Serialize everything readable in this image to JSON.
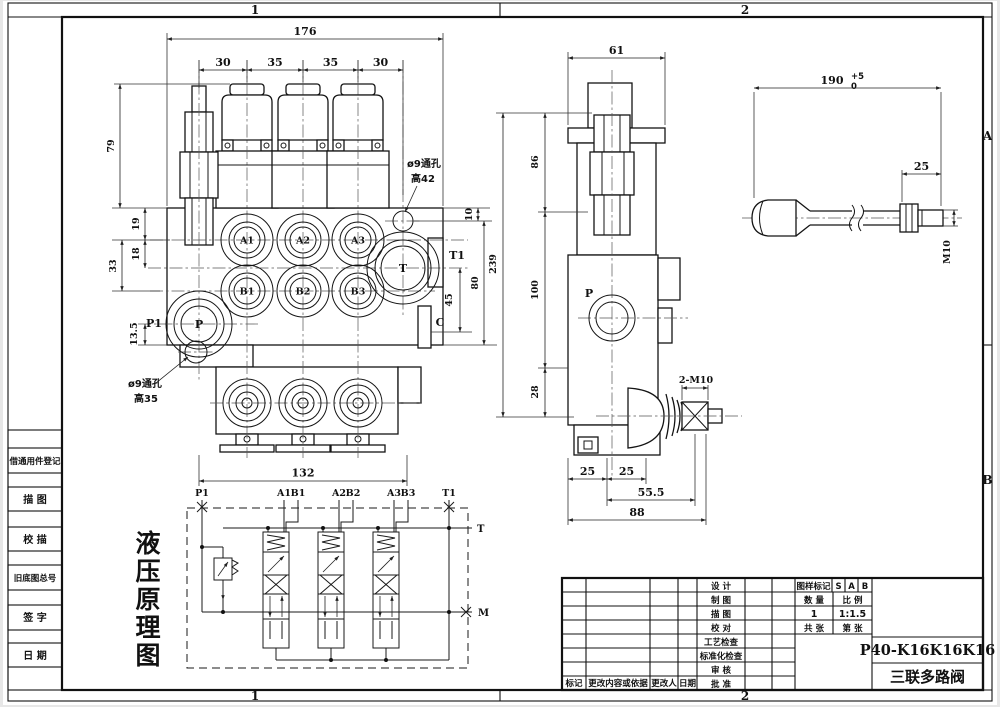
{
  "sheet": {
    "zones": {
      "top": [
        "1",
        "2"
      ],
      "bottom": [
        "1",
        "2"
      ],
      "right": [
        "A",
        "B"
      ]
    },
    "register_column": {
      "cells": [
        "借通用件登记",
        "描  图",
        "校  描",
        "旧底图总号",
        "签  字",
        "日  期"
      ]
    }
  },
  "front_view": {
    "dims": {
      "overall_width": "176",
      "spacings": [
        "30",
        "35",
        "35",
        "30"
      ],
      "height_top": "79",
      "a_offset": "19",
      "t_offset": "18",
      "b_offset": "33",
      "p_offset": "13.5",
      "hole_offset": "10",
      "right_height": "80",
      "c_offset": "45",
      "bottom_width": "132"
    },
    "ports": {
      "a1": "A1",
      "a2": "A2",
      "a3": "A3",
      "b1": "B1",
      "b2": "B2",
      "b3": "B3",
      "p": "P",
      "t": "T",
      "p1": "P1",
      "t1": "T1",
      "c": "C"
    },
    "callout_top": {
      "line1": "ø9通孔",
      "line2": "高42"
    },
    "callout_bottom": {
      "line1": "ø9通孔",
      "line2": "高35"
    }
  },
  "side_view": {
    "dims": {
      "top_width": "61",
      "overall": "239",
      "seg1": "86",
      "seg2": "100",
      "seg3": "28",
      "b1": "25",
      "b2": "25",
      "b3": "55.5",
      "b4": "88"
    },
    "labels": {
      "p": "P",
      "thread": "2-M10"
    }
  },
  "lever_view": {
    "dims": {
      "length": "190",
      "tol_up": "+5",
      "tol_dn": "0",
      "thread_len": "25",
      "thread": "M10"
    }
  },
  "schematic": {
    "title_chars": [
      "液",
      "压",
      "原",
      "理",
      "图"
    ],
    "ports": {
      "p1": "P1",
      "a1": "A1",
      "b1": "B1",
      "a2": "A2",
      "b2": "B2",
      "a3": "A3",
      "b3": "B3",
      "t1": "T1",
      "t": "T",
      "m": "M"
    }
  },
  "title_block": {
    "revision_headers": [
      "标记",
      "更改内容或依据",
      "更改人",
      "日期"
    ],
    "sign_labels": [
      "设  计",
      "制  图",
      "描  图",
      "校  对",
      "工艺检查",
      "标准化检查",
      "审  核",
      "批  准"
    ],
    "mark_label": "图样标记",
    "mark_cells": [
      "S",
      "A",
      "B"
    ],
    "qty_label": "数  量",
    "scale_label": "比  例",
    "qty_value": "1",
    "scale_value": "1:1.5",
    "total_label": "共  张",
    "index_label": "第  张",
    "part_number": "P40-K16K16K16",
    "part_name": "三联多路阀"
  }
}
